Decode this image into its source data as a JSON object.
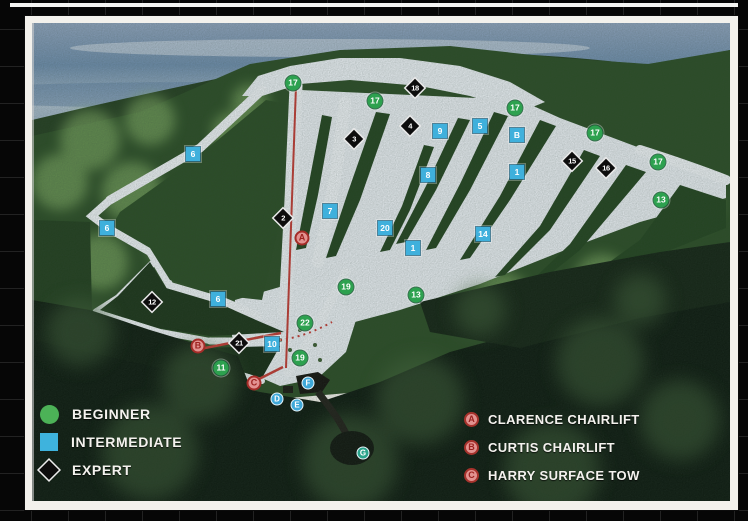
{
  "legend": {
    "items": [
      {
        "shape": "circle",
        "label": "BEGINNER",
        "color": "#4cb257"
      },
      {
        "shape": "square",
        "label": "INTERMEDIATE",
        "color": "#3eb3dd"
      },
      {
        "shape": "diamond",
        "label": "EXPERT",
        "color": "#0d0d0d"
      }
    ]
  },
  "lift_legend": {
    "items": [
      {
        "letter": "A",
        "label": "CLARENCE CHAIRLIFT"
      },
      {
        "letter": "B",
        "label": "CURTIS CHAIRLIFT"
      },
      {
        "letter": "C",
        "label": "HARRY SURFACE TOW"
      }
    ]
  },
  "colors": {
    "beginner": "#2da14f",
    "intermediate": "#3fb0dc",
    "expert": "#0d0d0d",
    "lift": "#e29290",
    "facility": "#3fa8d8"
  },
  "markers": [
    {
      "label": "17",
      "type": "beginner",
      "x": 293,
      "y": 83
    },
    {
      "label": "17",
      "type": "beginner",
      "x": 375,
      "y": 101
    },
    {
      "label": "17",
      "type": "beginner",
      "x": 515,
      "y": 108
    },
    {
      "label": "17",
      "type": "beginner",
      "x": 595,
      "y": 133
    },
    {
      "label": "17",
      "type": "beginner",
      "x": 658,
      "y": 162
    },
    {
      "label": "13",
      "type": "beginner",
      "x": 661,
      "y": 200
    },
    {
      "label": "13",
      "type": "beginner",
      "x": 416,
      "y": 295
    },
    {
      "label": "19",
      "type": "beginner",
      "x": 346,
      "y": 287
    },
    {
      "label": "19",
      "type": "beginner",
      "x": 300,
      "y": 358
    },
    {
      "label": "22",
      "type": "beginner",
      "x": 305,
      "y": 323
    },
    {
      "label": "11",
      "type": "beginner",
      "x": 221,
      "y": 368
    },
    {
      "label": "6",
      "type": "intermediate",
      "x": 193,
      "y": 154
    },
    {
      "label": "6",
      "type": "intermediate",
      "x": 107,
      "y": 228
    },
    {
      "label": "6",
      "type": "intermediate",
      "x": 218,
      "y": 299
    },
    {
      "label": "7",
      "type": "intermediate",
      "x": 330,
      "y": 211
    },
    {
      "label": "9",
      "type": "intermediate",
      "x": 440,
      "y": 131
    },
    {
      "label": "5",
      "type": "intermediate",
      "x": 480,
      "y": 126
    },
    {
      "label": "8",
      "type": "intermediate",
      "x": 428,
      "y": 175
    },
    {
      "label": "B",
      "type": "intermediate",
      "x": 517,
      "y": 135
    },
    {
      "label": "1",
      "type": "intermediate",
      "x": 517,
      "y": 172
    },
    {
      "label": "1",
      "type": "intermediate",
      "x": 413,
      "y": 248
    },
    {
      "label": "20",
      "type": "intermediate",
      "x": 385,
      "y": 228
    },
    {
      "label": "14",
      "type": "intermediate",
      "x": 483,
      "y": 234
    },
    {
      "label": "10",
      "type": "intermediate",
      "x": 272,
      "y": 344
    },
    {
      "label": "18",
      "type": "expert",
      "x": 415,
      "y": 88
    },
    {
      "label": "4",
      "type": "expert",
      "x": 410,
      "y": 126
    },
    {
      "label": "3",
      "type": "expert",
      "x": 354,
      "y": 139
    },
    {
      "label": "2",
      "type": "expert",
      "x": 283,
      "y": 218
    },
    {
      "label": "15",
      "type": "expert",
      "x": 572,
      "y": 161
    },
    {
      "label": "16",
      "type": "expert",
      "x": 606,
      "y": 168
    },
    {
      "label": "12",
      "type": "expert",
      "x": 152,
      "y": 302
    },
    {
      "label": "21",
      "type": "expert",
      "x": 239,
      "y": 343
    },
    {
      "label": "A",
      "type": "lift",
      "x": 302,
      "y": 238
    },
    {
      "label": "B",
      "type": "lift",
      "x": 198,
      "y": 346
    },
    {
      "label": "C",
      "type": "lift",
      "x": 254,
      "y": 383
    },
    {
      "label": "F",
      "type": "facility",
      "x": 308,
      "y": 383
    },
    {
      "label": "D",
      "type": "facility",
      "x": 277,
      "y": 399
    },
    {
      "label": "E",
      "type": "facility",
      "x": 297,
      "y": 405
    },
    {
      "label": "G",
      "type": "facility",
      "x": 363,
      "y": 453,
      "color": "#2aa38b"
    }
  ]
}
